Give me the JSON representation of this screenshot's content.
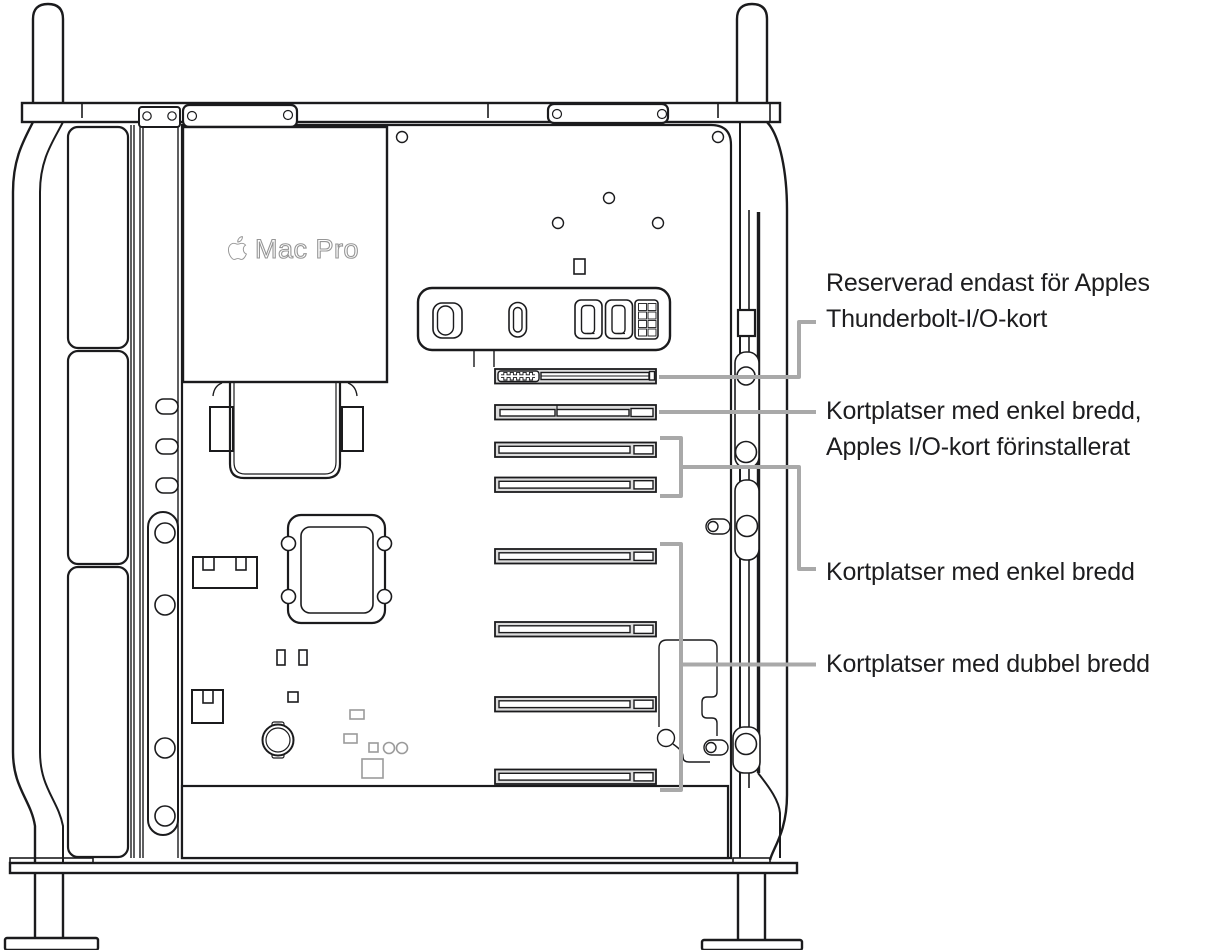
{
  "device": {
    "logo_text": "Mac Pro"
  },
  "callouts": [
    {
      "id": "thunderbolt-io-slot",
      "lines": [
        "Reserverad endast för Apples",
        "Thunderbolt-I/O-kort"
      ]
    },
    {
      "id": "single-width-preinstalled",
      "lines": [
        "Kortplatser med enkel bredd,",
        "Apples I/O-kort förinstallerat"
      ]
    },
    {
      "id": "single-width",
      "lines": [
        "Kortplatser med enkel bredd"
      ]
    },
    {
      "id": "double-width",
      "lines": [
        "Kortplatser med dubbel bredd"
      ]
    }
  ],
  "colors": {
    "outline": "#1b1b1d",
    "callout_line": "#a9a9a9",
    "label_text": "#1d1d1f",
    "slot_fill": "#dcdcdc",
    "muted_gray": "#9b9b9b",
    "logo_gray": "#969696",
    "background": "#ffffff"
  }
}
